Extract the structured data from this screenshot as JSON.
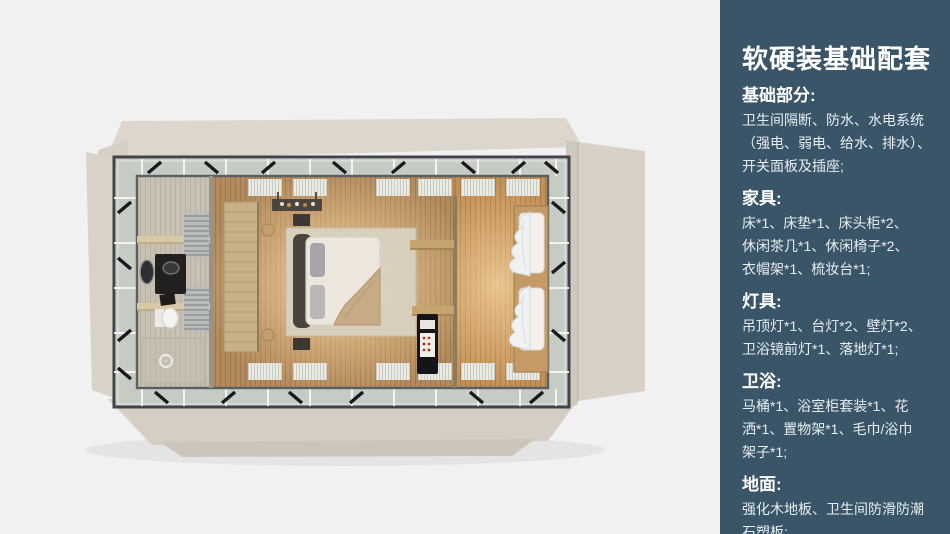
{
  "page": {
    "background": "#f1f1f2"
  },
  "sidebar": {
    "background": "#3b5568",
    "title": "软硬装基础配套",
    "sections": [
      {
        "heading": "基础部分:",
        "lines": [
          "卫生间隔断、防水、水电系统",
          "（强电、弱电、给水、排水）、",
          "开关面板及插座;"
        ]
      },
      {
        "heading": "家具:",
        "lines": [
          "床*1、床垫*1、床头柜*2、",
          "休闲茶几*1、休闲椅子*2、",
          "衣帽架*1、梳妆台*1;"
        ]
      },
      {
        "heading": "灯具:",
        "lines": [
          "吊顶灯*1、台灯*2、壁灯*2、",
          "卫浴镜前灯*1、落地灯*1;"
        ]
      },
      {
        "heading": "卫浴:",
        "lines": [
          "马桶*1、浴室柜套装*1、花",
          "洒*1、置物架*1、毛巾/浴巾",
          "架子*1;"
        ]
      },
      {
        "heading": "地面:",
        "lines": [
          "强化木地板、卫生间防滑防潮",
          "石塑板;"
        ]
      }
    ]
  },
  "floorplan": {
    "colors": {
      "shell_beige": "#ddd6cc",
      "metal_frame": "#3f444b",
      "walkway": "#c6cbc4",
      "bedroom_wood": "#b28a5c",
      "closet_wood": "#c29055",
      "bathroom_floor": "#c7c0b2",
      "warm_glow": "#ffd9a4",
      "bedding": "#ece6dd"
    }
  }
}
